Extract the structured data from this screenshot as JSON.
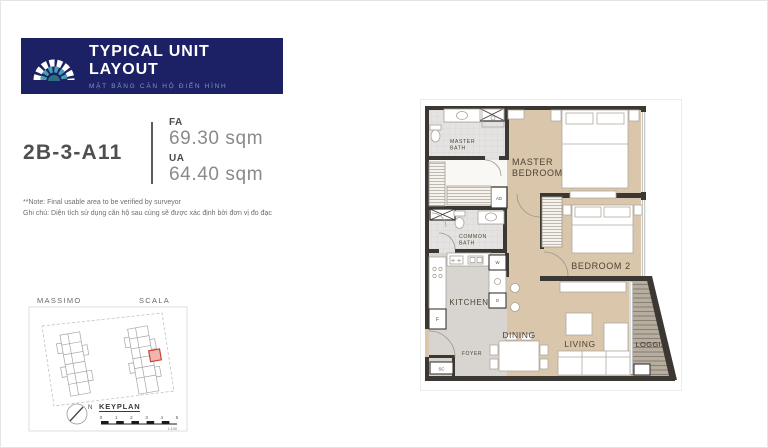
{
  "header": {
    "title": "TYPICAL UNIT LAYOUT",
    "subtitle": "MẶT BẰNG CĂN HỘ ĐIỂN HÌNH"
  },
  "unit": {
    "id": "2B-3-A11",
    "fa_label": "FA",
    "fa_value": "69.30 sqm",
    "ua_label": "UA",
    "ua_value": "64.40 sqm"
  },
  "note": {
    "line1": "**Note: Final usable area to be verified by surveyor",
    "line2": "Ghi chú: Diện tích sử dụng căn hộ sau cùng sẽ được xác định bởi đơn vị đo đạc"
  },
  "keyplan": {
    "left_tower": "MASSIMO",
    "right_tower": "SCALA",
    "title": "KEYPLAN",
    "north_label": "N",
    "scale_ticks": [
      "0",
      "1",
      "2",
      "3",
      "4",
      "5"
    ],
    "scale_ratio": "1:100"
  },
  "floorplan": {
    "rooms": {
      "master_bath_line1": "MASTER",
      "master_bath_line2": "BATH",
      "master_bedroom_line1": "MASTER",
      "master_bedroom_line2": "BEDROOM",
      "common_bath_line1": "COMMON",
      "common_bath_line2": "BATH",
      "bedroom2": "BEDROOM 2",
      "kitchen": "KITCHEN",
      "foyer": "FOYER",
      "dining": "DINING",
      "living": "LIVING",
      "loggia": "LOGGIA"
    },
    "tags": {
      "ad": "AD",
      "washer": "W",
      "dryer": "D",
      "fridge": "F",
      "shoe_cabinet": "SC"
    }
  },
  "colors": {
    "banner_navy": "#1c2166",
    "logo_teal": "#49a0b5",
    "subtitle_blue": "#8094b4",
    "unit_id_text": "#4f4f4f",
    "area_value_text": "#8a8a8a",
    "wall": "#3b3733",
    "wood_floor": "#d9c6ab",
    "tile_floor": "#e4e3e1",
    "kitchen_floor": "#d8d5d1",
    "loggia_floor": "#b7ae9f",
    "room_label": "#4e4336",
    "keyplan_highlight": "#cc4237"
  }
}
